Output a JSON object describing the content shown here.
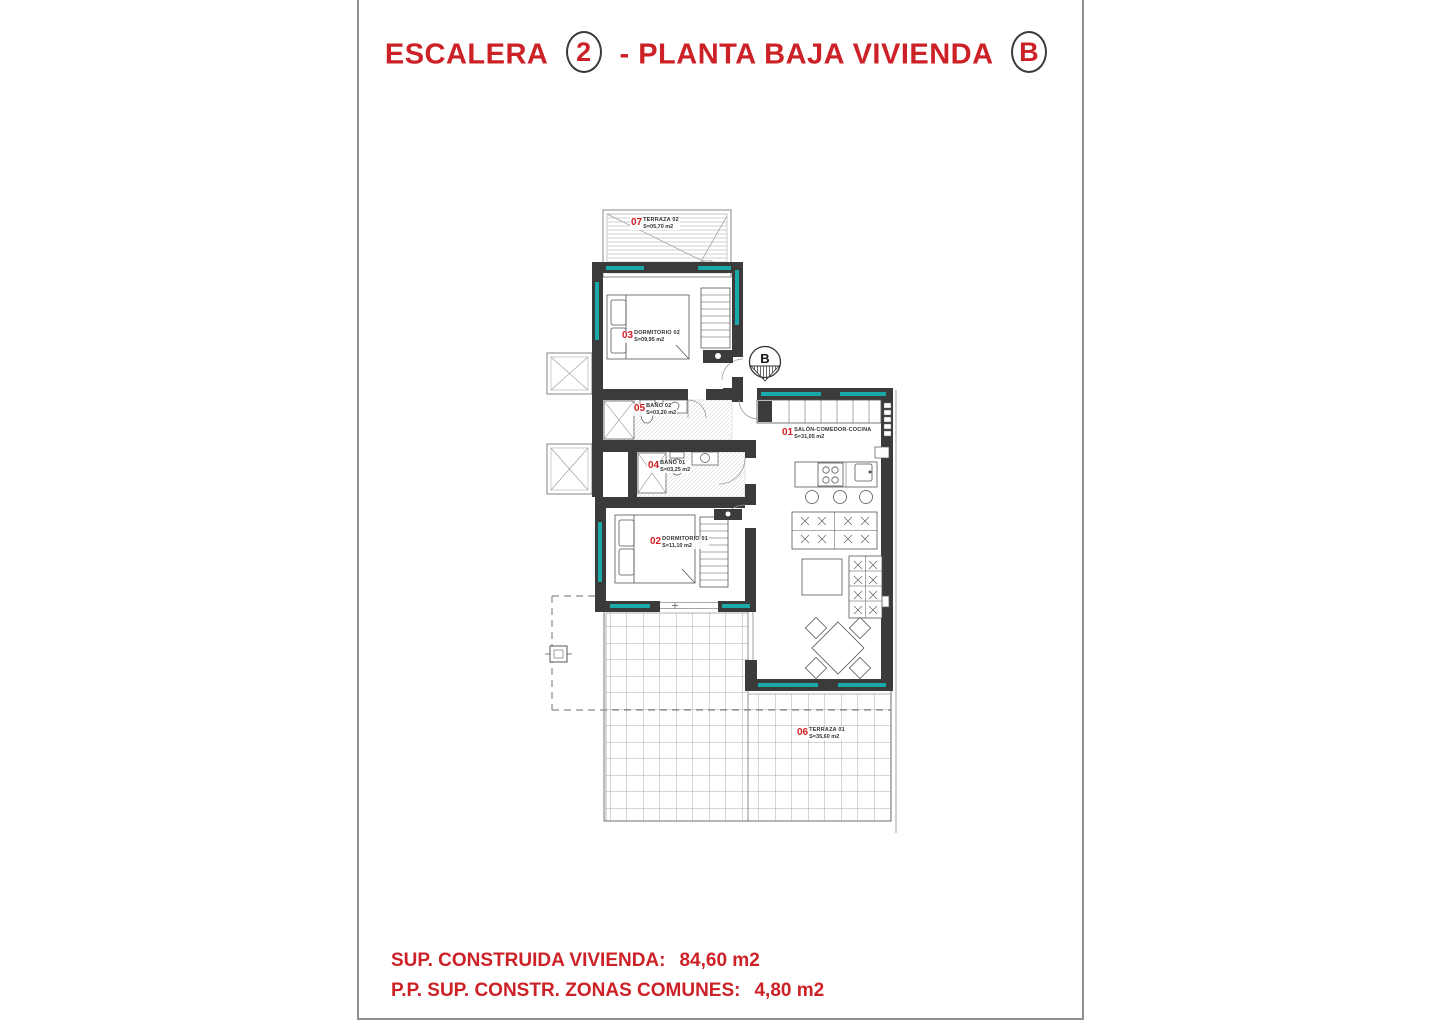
{
  "sheet": {
    "title": {
      "left": "ESCALERA",
      "stair_number": "2",
      "middle": "- PLANTA BAJA VIVIENDA",
      "dwelling_letter": "B"
    },
    "summary": [
      {
        "label": "SUP. CONSTRUIDA VIVIENDA:",
        "value": "84,60 m2"
      },
      {
        "label": "P.P. SUP. CONSTR. ZONAS COMUNES:",
        "value": "4,80 m2"
      }
    ]
  },
  "plan": {
    "entrance_marker": "B",
    "rooms": [
      {
        "num": "01",
        "name": "SALÓN-COMEDOR-COCINA",
        "area": "S=31,05 m2"
      },
      {
        "num": "02",
        "name": "DORMITORIO 01",
        "area": "S=11,10 m2"
      },
      {
        "num": "03",
        "name": "DORMITORIO 02",
        "area": "S=09,95 m2"
      },
      {
        "num": "04",
        "name": "BAÑO 01",
        "area": "S=03,25 m2"
      },
      {
        "num": "05",
        "name": "BAÑO 02",
        "area": "S=03,20 m2"
      },
      {
        "num": "06",
        "name": "TERRAZA 01",
        "area": "S=35,60 m2"
      },
      {
        "num": "07",
        "name": "TERRAZA 02",
        "area": "S=05,70 m2"
      }
    ]
  },
  "colors": {
    "accent_red": "#cc2127",
    "wall_dark": "#3b3b3b",
    "glazing_teal": "#1ba8a8"
  }
}
